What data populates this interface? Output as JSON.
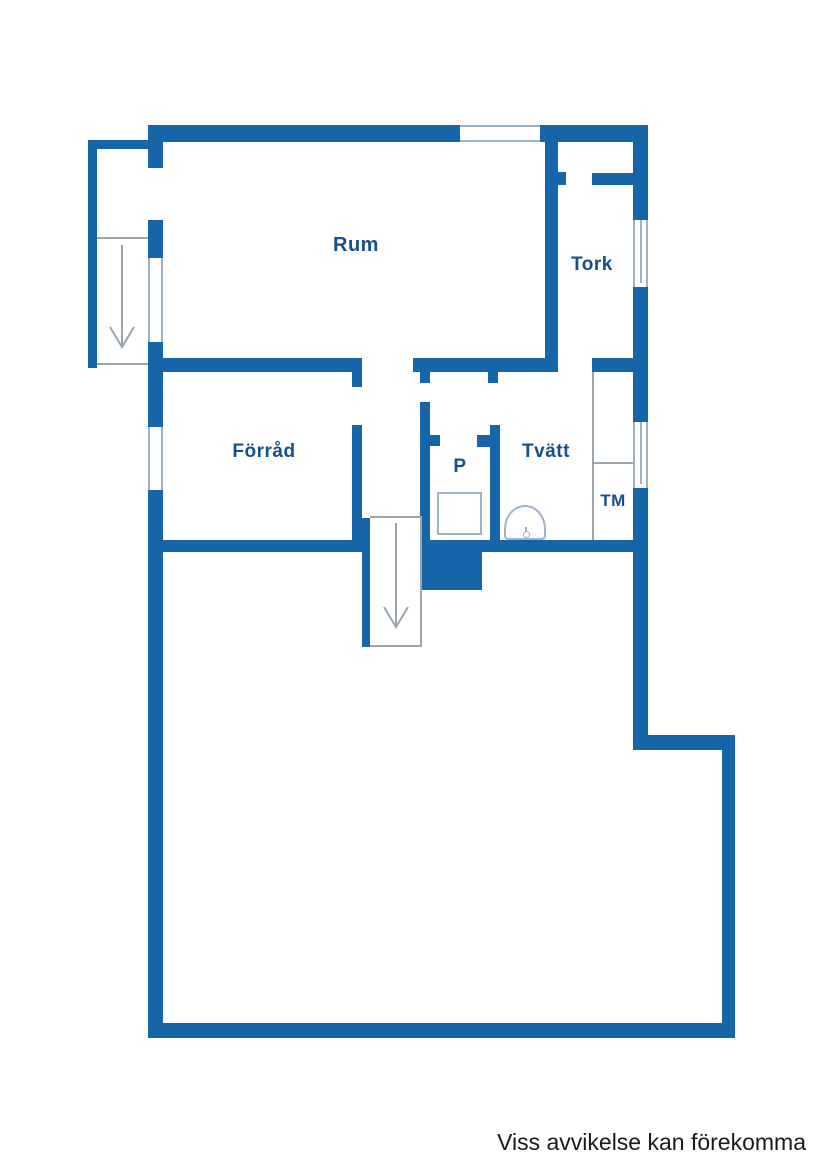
{
  "colors": {
    "wall": "#1565a8",
    "label_text": "#14508c",
    "thin_line": "#9aa5ad",
    "window_line": "#9fb3c6",
    "fixture_line": "#9eb3c9",
    "footer_text": "#1a1a1a"
  },
  "rooms": {
    "rum": {
      "label": "Rum"
    },
    "tork": {
      "label": "Tork"
    },
    "forrad": {
      "label": "Förråd"
    },
    "p": {
      "label": "P"
    },
    "tvatt": {
      "label": "Tvätt"
    },
    "tm": {
      "label": "TM"
    }
  },
  "symbols": {
    "stairs_down_main": "stairs-down-arrow",
    "stairs_down_annex": "stairs-down-arrow"
  },
  "footer": {
    "disclaimer": "Viss avvikelse kan förekomma"
  }
}
